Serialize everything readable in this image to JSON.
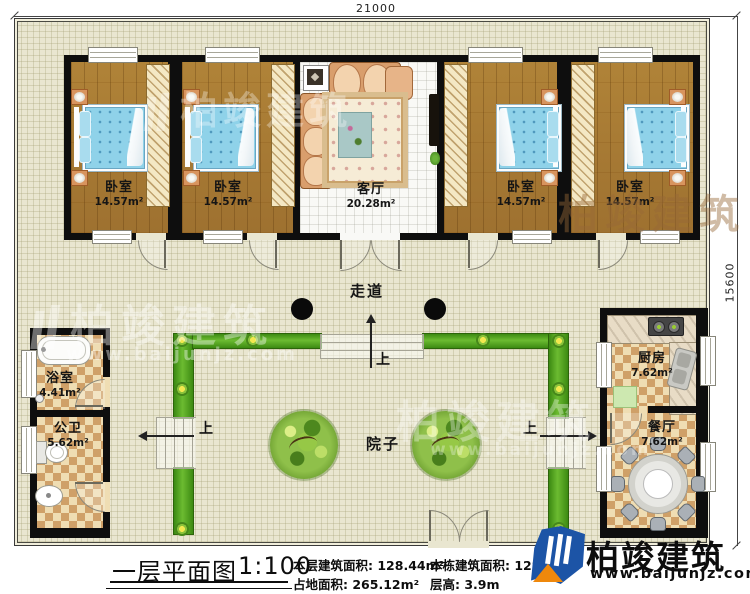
{
  "drawing": {
    "title": "一层平面图",
    "scale": "1:100",
    "stats": [
      {
        "label": "本层建筑面积:",
        "value": "128.44m²"
      },
      {
        "label": "占地面积:",
        "value": "265.12m²"
      },
      {
        "label": "本栋建筑面积:",
        "value": "128.4"
      },
      {
        "label": "层高:",
        "value": "3.9m"
      }
    ]
  },
  "dimensions": {
    "top_width": "21000",
    "right_height": "15600"
  },
  "rooms": {
    "bedroom1": {
      "name": "卧室",
      "area": "14.57m²"
    },
    "bedroom2": {
      "name": "卧室",
      "area": "14.57m²"
    },
    "living": {
      "name": "客厅",
      "area": "20.28m²"
    },
    "bedroom3": {
      "name": "卧室",
      "area": "14.57m²"
    },
    "bedroom4": {
      "name": "卧室",
      "area": "14.57m²"
    },
    "bathroom": {
      "name": "浴室",
      "area": "4.41m²"
    },
    "toilet": {
      "name": "公卫",
      "area": "5.62m²"
    },
    "kitchen": {
      "name": "厨房",
      "area": "7.62m²"
    },
    "dining": {
      "name": "餐厅",
      "area": "7.62m²"
    },
    "corridor": {
      "name": "走道"
    },
    "courtyard": {
      "name": "院子"
    }
  },
  "labels": {
    "up": "上"
  },
  "brand": {
    "name": "柏竣建筑",
    "url": "www.baijunjz.com"
  },
  "watermark": {
    "name": "柏竣建筑",
    "url": "www.baijunjz.com"
  },
  "colors": {
    "wall": "#0e0e0e",
    "wood_floor": "#a87b36",
    "bed_blue": "#8fd2e9",
    "tile_dark": "#cfa068",
    "tile_light": "#efddb3",
    "greenery": "#4f9e1c",
    "grid_bg": "#e9e6d0",
    "brand_blue": "#1c54a6",
    "brand_orange": "#ef880c"
  }
}
